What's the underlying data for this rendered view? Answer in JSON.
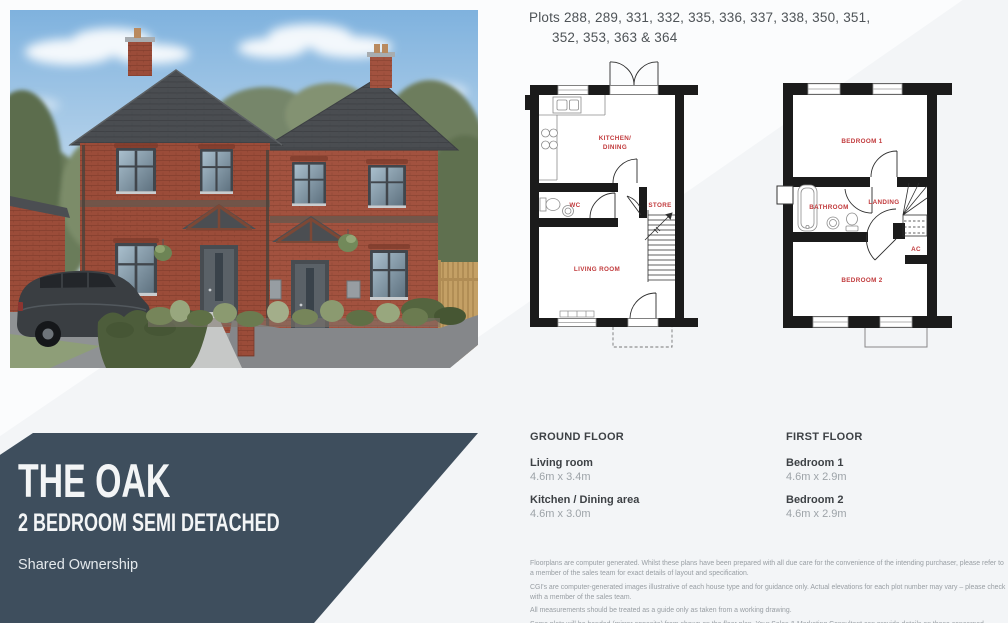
{
  "header": {
    "plots_line1": "Plots 288, 289, 331, 332, 335, 336, 337, 338, 350, 351,",
    "plots_line2": "352, 353, 363 & 364"
  },
  "floorplans": {
    "label_color": "#c13a3c",
    "wall_color": "#1b1b1b",
    "ground_floor": {
      "kitchen_line1": "KITCHEN/",
      "kitchen_line2": "DINING",
      "wc": "WC",
      "store": "STORE",
      "living_room": "LIVING ROOM"
    },
    "first_floor": {
      "bedroom1": "BEDROOM 1",
      "bathroom": "BATHROOM",
      "landing": "LANDING",
      "ac": "AC",
      "bedroom2": "BEDROOM 2"
    }
  },
  "specs": {
    "ground_floor": {
      "heading": "GROUND FLOOR",
      "rooms": [
        {
          "name": "Living room",
          "size": "4.6m x 3.4m"
        },
        {
          "name": "Kitchen / Dining area",
          "size": "4.6m x 3.0m"
        }
      ]
    },
    "first_floor": {
      "heading": "FIRST FLOOR",
      "rooms": [
        {
          "name": "Bedroom 1",
          "size": "4.6m x 2.9m"
        },
        {
          "name": "Bedroom 2",
          "size": "4.6m x 2.9m"
        }
      ]
    }
  },
  "disclaimer": {
    "p1": "Floorplans are computer generated. Whilst these plans have been prepared with all due care for the convenience of the intending purchaser, please refer to a member of the sales team for exact details of layout and specification.",
    "p2": "CGI's are computer-generated images illustrative of each house type and for guidance only. Actual elevations for each plot number may vary – please check with a member of the sales team.",
    "p3": "All measurements should be treated as a guide only as taken from a working drawing.",
    "p4": "Some plots will be handed (mirror opposite) from shown on the floor plan. Your Sales & Marketing Consultant can provide details on those concerned."
  },
  "banner": {
    "title": "THE OAK",
    "subtitle": "2 BEDROOM SEMI DETACHED",
    "tenure": "Shared Ownership",
    "background_color": "#3e4e5d"
  }
}
